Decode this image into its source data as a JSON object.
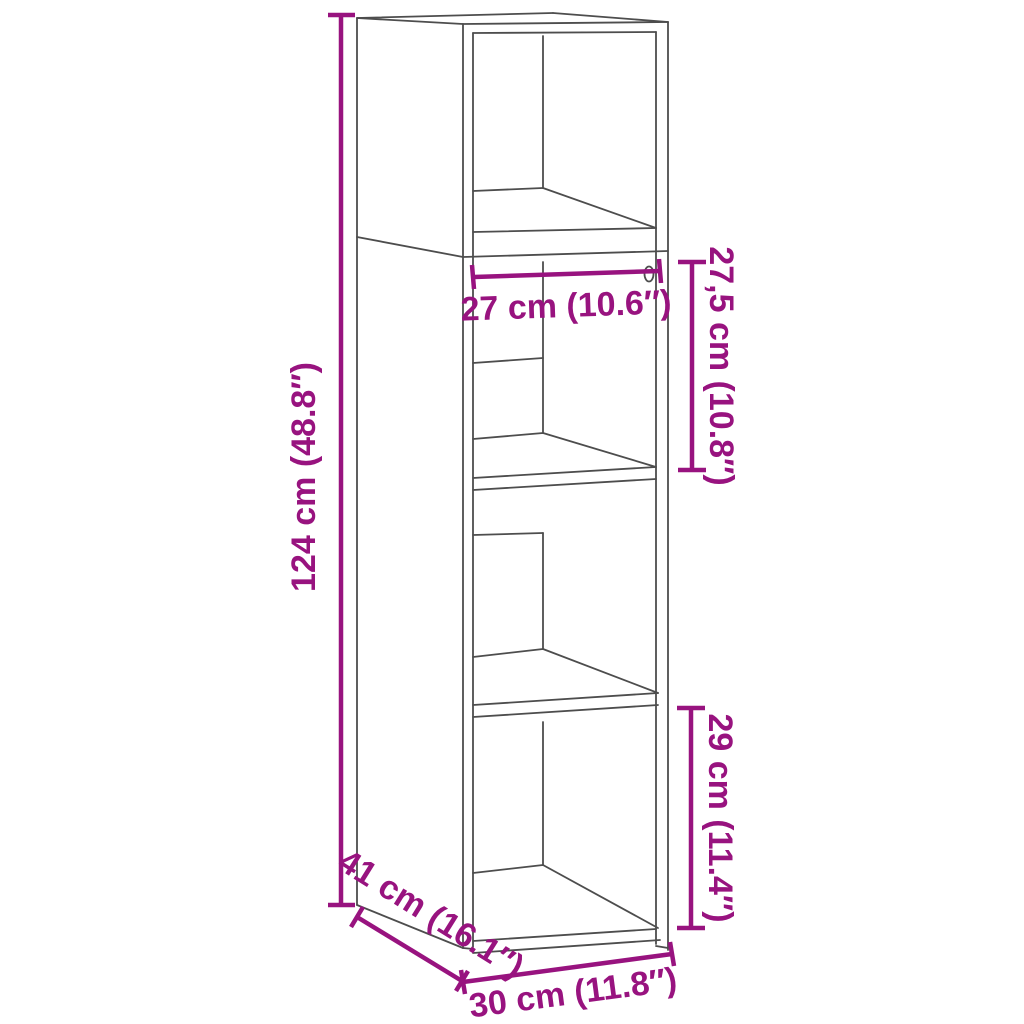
{
  "title": "Cabinet dimension diagram",
  "colors": {
    "dimension_accent": "#98137F",
    "line_art": "#4D4D4D",
    "background": "#FFFFFF"
  },
  "dimensions": {
    "total_height": {
      "label": "124 cm (48.8″)",
      "cm": "124",
      "inches": "48.8"
    },
    "inner_width": {
      "label": "27 cm (10.6″)",
      "cm": "27",
      "inches": "10.6"
    },
    "upper_shelf_height": {
      "label": "27,5 cm (10.8″)",
      "cm": "27,5",
      "inches": "10.8"
    },
    "lower_shelf_height": {
      "label": "29 cm (11.4″)",
      "cm": "29",
      "inches": "11.4"
    },
    "depth": {
      "label": "41 cm (16.1″)",
      "cm": "41",
      "inches": "16.1"
    },
    "width": {
      "label": "30 cm (11.8″)",
      "cm": "30",
      "inches": "11.8"
    }
  }
}
